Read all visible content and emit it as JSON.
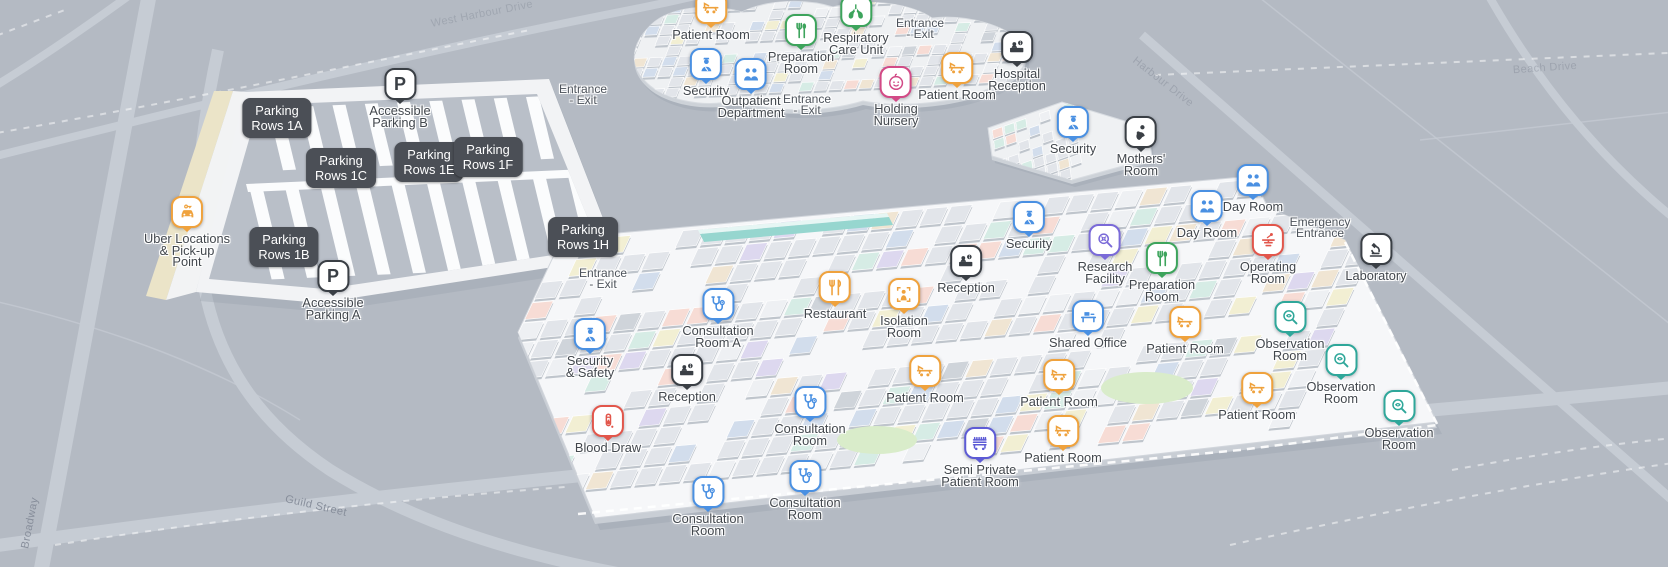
{
  "colors": {
    "background": "#b4bac3",
    "orange": "#EFA23D",
    "blue": "#4A90E2",
    "green": "#3DA45C",
    "red": "#E2564B",
    "purple": "#7A6AD8",
    "indigo": "#5D5BD5",
    "teal": "#2FA79A",
    "pink": "#D24A86",
    "dark": "#3A3F45"
  },
  "streets": [
    {
      "id": "broadway",
      "name": "Broadway",
      "x": 30,
      "y": 523,
      "rotate": -79,
      "opacity": 0.9
    },
    {
      "id": "guild-street",
      "name": "Guild Street",
      "x": 316,
      "y": 506,
      "rotate": 13,
      "opacity": 0.9
    },
    {
      "id": "harbour-drive",
      "name": "Harbour Drive",
      "x": 1163,
      "y": 82,
      "rotate": 38,
      "opacity": 0.45
    },
    {
      "id": "beach-drive",
      "name": "Beach Drive",
      "x": 1545,
      "y": 68,
      "rotate": -4,
      "opacity": 0.45
    },
    {
      "id": "west-harbour-drive",
      "name": "West Harbour Drive",
      "x": 482,
      "y": 14,
      "rotate": -11,
      "opacity": 0.4
    }
  ],
  "labels": [
    {
      "id": "entrance-exit-north-1",
      "text": "Entrance\n- Exit",
      "x": 920,
      "y": 29
    },
    {
      "id": "entrance-exit-north-2",
      "text": "Entrance\n- Exit",
      "x": 807,
      "y": 105
    },
    {
      "id": "entrance-exit-parking-1",
      "text": "Entrance\n- Exit",
      "x": 583,
      "y": 95
    },
    {
      "id": "entrance-exit-parking-2",
      "text": "Entrance\n- Exit",
      "x": 603,
      "y": 279
    },
    {
      "id": "emergency-entrance",
      "text": "Emergency\nEntrance",
      "x": 1320,
      "y": 228
    }
  ],
  "chips": [
    {
      "id": "parking-rows-1a",
      "text": "Parking\nRows 1A",
      "x": 277,
      "y": 118
    },
    {
      "id": "parking-rows-1c",
      "text": "Parking\nRows 1C",
      "x": 341,
      "y": 168
    },
    {
      "id": "parking-rows-1e",
      "text": "Parking\nRows 1E",
      "x": 429,
      "y": 162
    },
    {
      "id": "parking-rows-1f",
      "text": "Parking\nRows 1F",
      "x": 488,
      "y": 157
    },
    {
      "id": "parking-rows-1b",
      "text": "Parking\nRows 1B",
      "x": 284,
      "y": 247
    },
    {
      "id": "parking-rows-1h",
      "text": "Parking\nRows 1H",
      "x": 583,
      "y": 237
    }
  ],
  "pins": [
    {
      "id": "patient-room-n1",
      "icon": "bed",
      "color": "orange",
      "x": 711,
      "y": 8,
      "label": "Patient Room"
    },
    {
      "id": "preparation-room-n",
      "icon": "prep",
      "color": "green",
      "x": 801,
      "y": 30,
      "label": "Preparation\nRoom"
    },
    {
      "id": "respiratory-care-unit",
      "icon": "lungs",
      "color": "green",
      "x": 856,
      "y": 11,
      "label": "Respiratory\nCare Unit"
    },
    {
      "id": "security-north",
      "icon": "security",
      "color": "blue",
      "x": 706,
      "y": 64,
      "label": "Security"
    },
    {
      "id": "outpatient-department",
      "icon": "people",
      "color": "blue",
      "x": 751,
      "y": 74,
      "label": "Outpatient\nDepartment"
    },
    {
      "id": "holding-nursery",
      "icon": "baby",
      "color": "pink",
      "x": 896,
      "y": 82,
      "label": "Holding\nNursery"
    },
    {
      "id": "patient-room-n2",
      "icon": "bed",
      "color": "orange",
      "x": 957,
      "y": 68,
      "label": "Patient Room"
    },
    {
      "id": "hospital-reception",
      "icon": "reception",
      "color": "dark",
      "x": 1017,
      "y": 47,
      "label": "Hospital\nReception"
    },
    {
      "id": "security-east",
      "icon": "security",
      "color": "blue",
      "x": 1073,
      "y": 122,
      "label": "Security"
    },
    {
      "id": "mothers-room",
      "icon": "mother",
      "color": "dark",
      "x": 1141,
      "y": 132,
      "label": "Mothers'\nRoom"
    },
    {
      "id": "accessible-parking-b",
      "icon": "parking",
      "color": "dark",
      "x": 400,
      "y": 84,
      "label": "Accessible\nParking B"
    },
    {
      "id": "accessible-parking-a",
      "icon": "parking",
      "color": "dark",
      "x": 333,
      "y": 276,
      "label": "Accessible\nParking A"
    },
    {
      "id": "uber-pickup-point",
      "icon": "car",
      "color": "orange",
      "x": 187,
      "y": 212,
      "label": "Uber Locations\n& Pick-up\nPoint"
    },
    {
      "id": "security-and-safety",
      "icon": "security",
      "color": "blue",
      "x": 590,
      "y": 334,
      "label": "Security\n& Safety"
    },
    {
      "id": "consultation-room-a",
      "icon": "steth",
      "color": "blue",
      "x": 718,
      "y": 304,
      "label": "Consultation\nRoom A"
    },
    {
      "id": "reception-west",
      "icon": "reception",
      "color": "dark",
      "x": 687,
      "y": 370,
      "label": "Reception"
    },
    {
      "id": "blood-draw",
      "icon": "blood",
      "color": "red",
      "x": 608,
      "y": 421,
      "label": "Blood Draw"
    },
    {
      "id": "restaurant",
      "icon": "utensils",
      "color": "orange",
      "x": 835,
      "y": 287,
      "label": "Restaurant"
    },
    {
      "id": "isolation-room",
      "icon": "isolation",
      "color": "orange",
      "x": 904,
      "y": 294,
      "label": "Isolation\nRoom"
    },
    {
      "id": "reception-center",
      "icon": "reception",
      "color": "dark",
      "x": 966,
      "y": 261,
      "label": "Reception"
    },
    {
      "id": "security-center",
      "icon": "security",
      "color": "blue",
      "x": 1029,
      "y": 217,
      "label": "Security"
    },
    {
      "id": "research-facility",
      "icon": "research",
      "color": "purple",
      "x": 1105,
      "y": 240,
      "label": "Research\nFacility"
    },
    {
      "id": "preparation-room-c",
      "icon": "prep",
      "color": "green",
      "x": 1162,
      "y": 258,
      "label": "Preparation\nRoom"
    },
    {
      "id": "day-room-1",
      "icon": "people",
      "color": "blue",
      "x": 1207,
      "y": 206,
      "label": "Day Room"
    },
    {
      "id": "day-room-2",
      "icon": "people",
      "color": "blue",
      "x": 1253,
      "y": 180,
      "label": "Day Room"
    },
    {
      "id": "operating-room",
      "icon": "operating",
      "color": "red",
      "x": 1268,
      "y": 240,
      "label": "Operating\nRoom"
    },
    {
      "id": "laboratory",
      "icon": "microscope",
      "color": "dark",
      "x": 1376,
      "y": 249,
      "label": "Laboratory"
    },
    {
      "id": "shared-office",
      "icon": "office",
      "color": "blue",
      "x": 1088,
      "y": 316,
      "label": "Shared Office"
    },
    {
      "id": "patient-room-1",
      "icon": "bed",
      "color": "orange",
      "x": 1185,
      "y": 322,
      "label": "Patient Room"
    },
    {
      "id": "observation-room-1",
      "icon": "eye",
      "color": "teal",
      "x": 1290,
      "y": 317,
      "label": "Observation\nRoom"
    },
    {
      "id": "observation-room-2",
      "icon": "eye",
      "color": "teal",
      "x": 1341,
      "y": 360,
      "label": "Observation\nRoom"
    },
    {
      "id": "observation-room-3",
      "icon": "eye",
      "color": "teal",
      "x": 1399,
      "y": 406,
      "label": "Observation\nRoom"
    },
    {
      "id": "patient-room-2",
      "icon": "bed",
      "color": "orange",
      "x": 925,
      "y": 371,
      "label": "Patient Room"
    },
    {
      "id": "patient-room-3",
      "icon": "bed",
      "color": "orange",
      "x": 1059,
      "y": 375,
      "label": "Patient Room"
    },
    {
      "id": "patient-room-4",
      "icon": "bed",
      "color": "orange",
      "x": 1257,
      "y": 388,
      "label": "Patient Room"
    },
    {
      "id": "patient-room-5",
      "icon": "bed",
      "color": "orange",
      "x": 1063,
      "y": 431,
      "label": "Patient Room"
    },
    {
      "id": "semi-private-patient-room",
      "icon": "bedgrid",
      "color": "indigo",
      "x": 980,
      "y": 443,
      "label": "Semi Private\nPatient Room"
    },
    {
      "id": "consultation-room-1",
      "icon": "steth",
      "color": "blue",
      "x": 810,
      "y": 402,
      "label": "Consultation\nRoom"
    },
    {
      "id": "consultation-room-2",
      "icon": "steth",
      "color": "blue",
      "x": 805,
      "y": 476,
      "label": "Consultation\nRoom"
    },
    {
      "id": "consultation-room-3",
      "icon": "steth",
      "color": "blue",
      "x": 708,
      "y": 492,
      "label": "Consultation\nRoom"
    }
  ]
}
